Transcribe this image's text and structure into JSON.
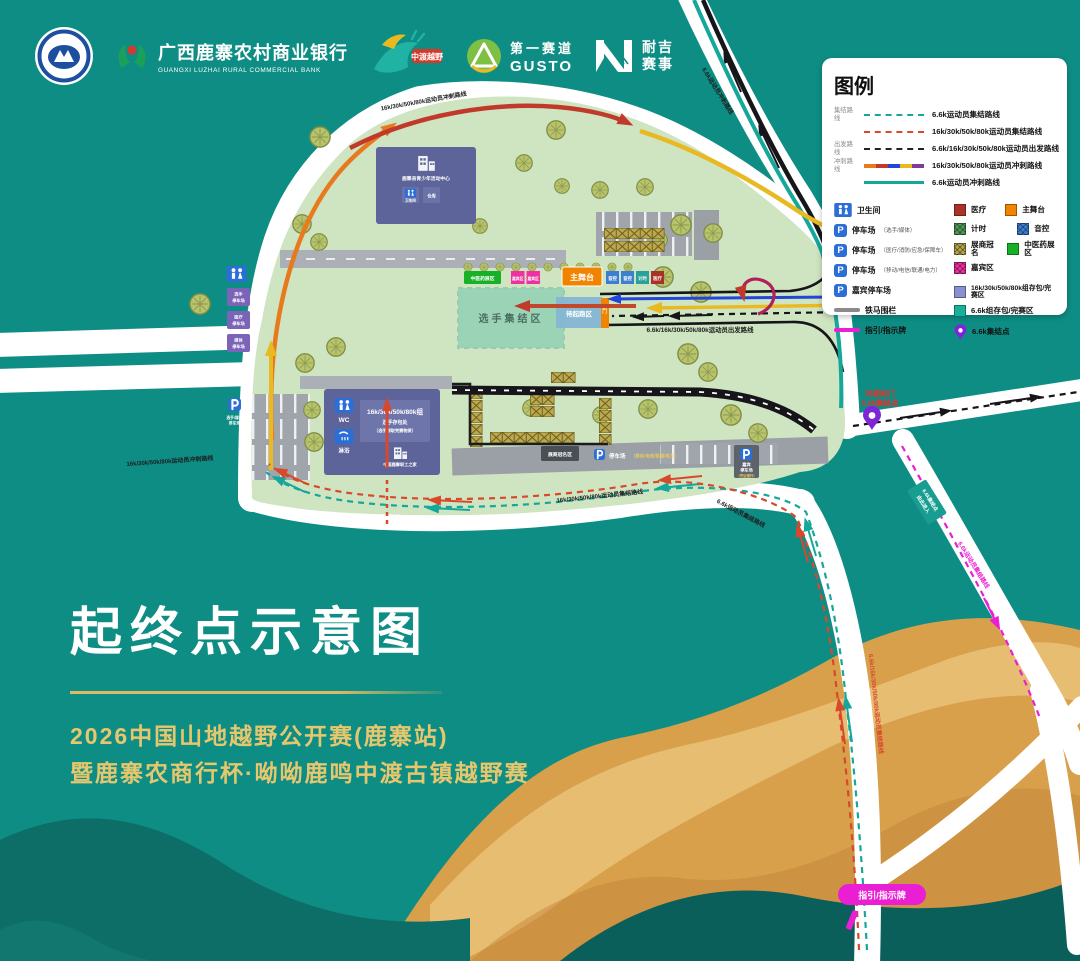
{
  "header": {
    "bank": {
      "title": "广西鹿寨农村商业银行",
      "subtitle": "GUANGXI LUZHAI RURAL COMMERCIAL BANK"
    },
    "mascot_text": "中渡越野",
    "gusto": {
      "line1": "第一赛道",
      "line2": "GUSTO"
    },
    "naiji": {
      "line1": "耐吉",
      "line2": "赛事"
    }
  },
  "icons": {
    "parking": "P"
  },
  "legend": {
    "title": "图例",
    "groups": [
      "集结路线",
      "出发路线",
      "冲刺路线"
    ],
    "routes": [
      {
        "label": "6.6k运动员集结路线",
        "style": "teal-dashed"
      },
      {
        "label": "16k/30k/50k/80k运动员集结路线",
        "style": "red-dashed"
      },
      {
        "label": "6.6k/16k/30k/50k/80k运动员出发路线",
        "style": "black-dashed"
      },
      {
        "label": "16k/30k/50k/80k运动员冲刺路线",
        "style": "multicolor"
      },
      {
        "label": "6.6k运动员冲刺路线",
        "style": "teal-solid"
      }
    ],
    "facilities": [
      {
        "label": "卫生间"
      },
      {
        "label": "停车场",
        "note": "（选手/媒体）"
      },
      {
        "label": "停车场",
        "note": "（医疗/消防/应急/保障车）"
      },
      {
        "label": "停车场",
        "note": "（移动/电信/联通/电力）"
      },
      {
        "label": "嘉宾停车场"
      },
      {
        "label": "铁马围栏"
      },
      {
        "label": "指引/指示牌"
      }
    ],
    "areas": [
      {
        "label": "医疗",
        "color": "#a93226"
      },
      {
        "label": "主舞台",
        "color": "#f08300"
      },
      {
        "label": "计时",
        "color": "#4e9b57"
      },
      {
        "label": "音控",
        "color": "#3c7fd1"
      },
      {
        "label": "展商冠名",
        "color": "#b5a44a"
      },
      {
        "label": "中医药展区",
        "color": "#17b026"
      },
      {
        "label": "嘉宾区",
        "color": "#f0309f"
      },
      {
        "label": "16k/30k/50k/80k组存包/完赛区",
        "color": "#8a8fd2"
      },
      {
        "label": "6.6k组存包/完赛区",
        "color": "#17b09b"
      }
    ],
    "pin_label": "6.6k集结点"
  },
  "map": {
    "route_labels": {
      "sprint_top": "16k/30k/50k/80k运动员冲刺路线",
      "sprint_right_road": "6.6k运动员冲刺路线",
      "sprint_left_road": "16k/30k/50k/80k运动员冲刺路线",
      "start_corridor": "6.6k/16k/30k/50k/80k运动员出发路线",
      "muster_main": "16k/30k/50k/80k运动员集结路线",
      "muster_66_side": "6.6k运动员集结路线",
      "muster_down": "6.6k/16k/30k/50k/80k运动员集结路线",
      "muster_magenta": "6.6k运动员集结路线"
    },
    "poi": {
      "gate_l1": "河堤闸门",
      "gate_l2": "6.6k集结点",
      "board": "指引/指示牌",
      "teal_sign_l1": "6.6k集结点",
      "teal_sign_l2": "由此进入"
    },
    "zones": {
      "tcm": "中医药展区",
      "guest": "嘉宾区",
      "stage": "主舞台",
      "sq1": "音控",
      "sq2": "音控",
      "sq3": "计时",
      "sq4": "医疗",
      "muster": "选手集结区",
      "prestart": "待起跑区",
      "arch": "拱门",
      "expo_booth": "展商冠名区",
      "parking_mid_label": "停车场",
      "parking_mid_note": "（移动/电信/联通/电力）",
      "parking_right_l1": "嘉宾",
      "parking_right_l2": "停车场",
      "parking_right_note": "（凭证通行）",
      "parking_left_l1": "选手/媒体",
      "parking_left_l2": "停车场"
    },
    "left_signs": [
      {
        "l1": "选手",
        "l2": "停车场"
      },
      {
        "l1": "医疗",
        "l2": "停车场"
      },
      {
        "l1": "媒体",
        "l2": "停车场"
      }
    ],
    "buildings": {
      "b1_label": "鹿寨县青少年活动中心",
      "b1_room1": "卫生间",
      "b1_room2": "仓库",
      "b2_wc": "WC",
      "b2_shower": "淋浴",
      "b2_bag_l1": "16k/30k/50k/80k组",
      "b2_bag_l2": "选手存包处",
      "b2_bag_l3": "（选手领取完赛物资）",
      "b2_home": "中国鹿寨职工之家"
    }
  },
  "title_block": {
    "title": "起终点示意图",
    "line1": "2026中国山地越野公开赛(鹿寨站)",
    "line2": "暨鹿寨农商行杯·呦呦鹿鸣中渡古镇越野赛"
  },
  "colors": {
    "background": "#0e8d85",
    "venue": "#cfe4c1",
    "accent_teal": "#16a79b",
    "route_red": "#d9482b",
    "magenta": "#ea1fd4",
    "gold": "#e7c76e",
    "road": "#ffffff"
  }
}
